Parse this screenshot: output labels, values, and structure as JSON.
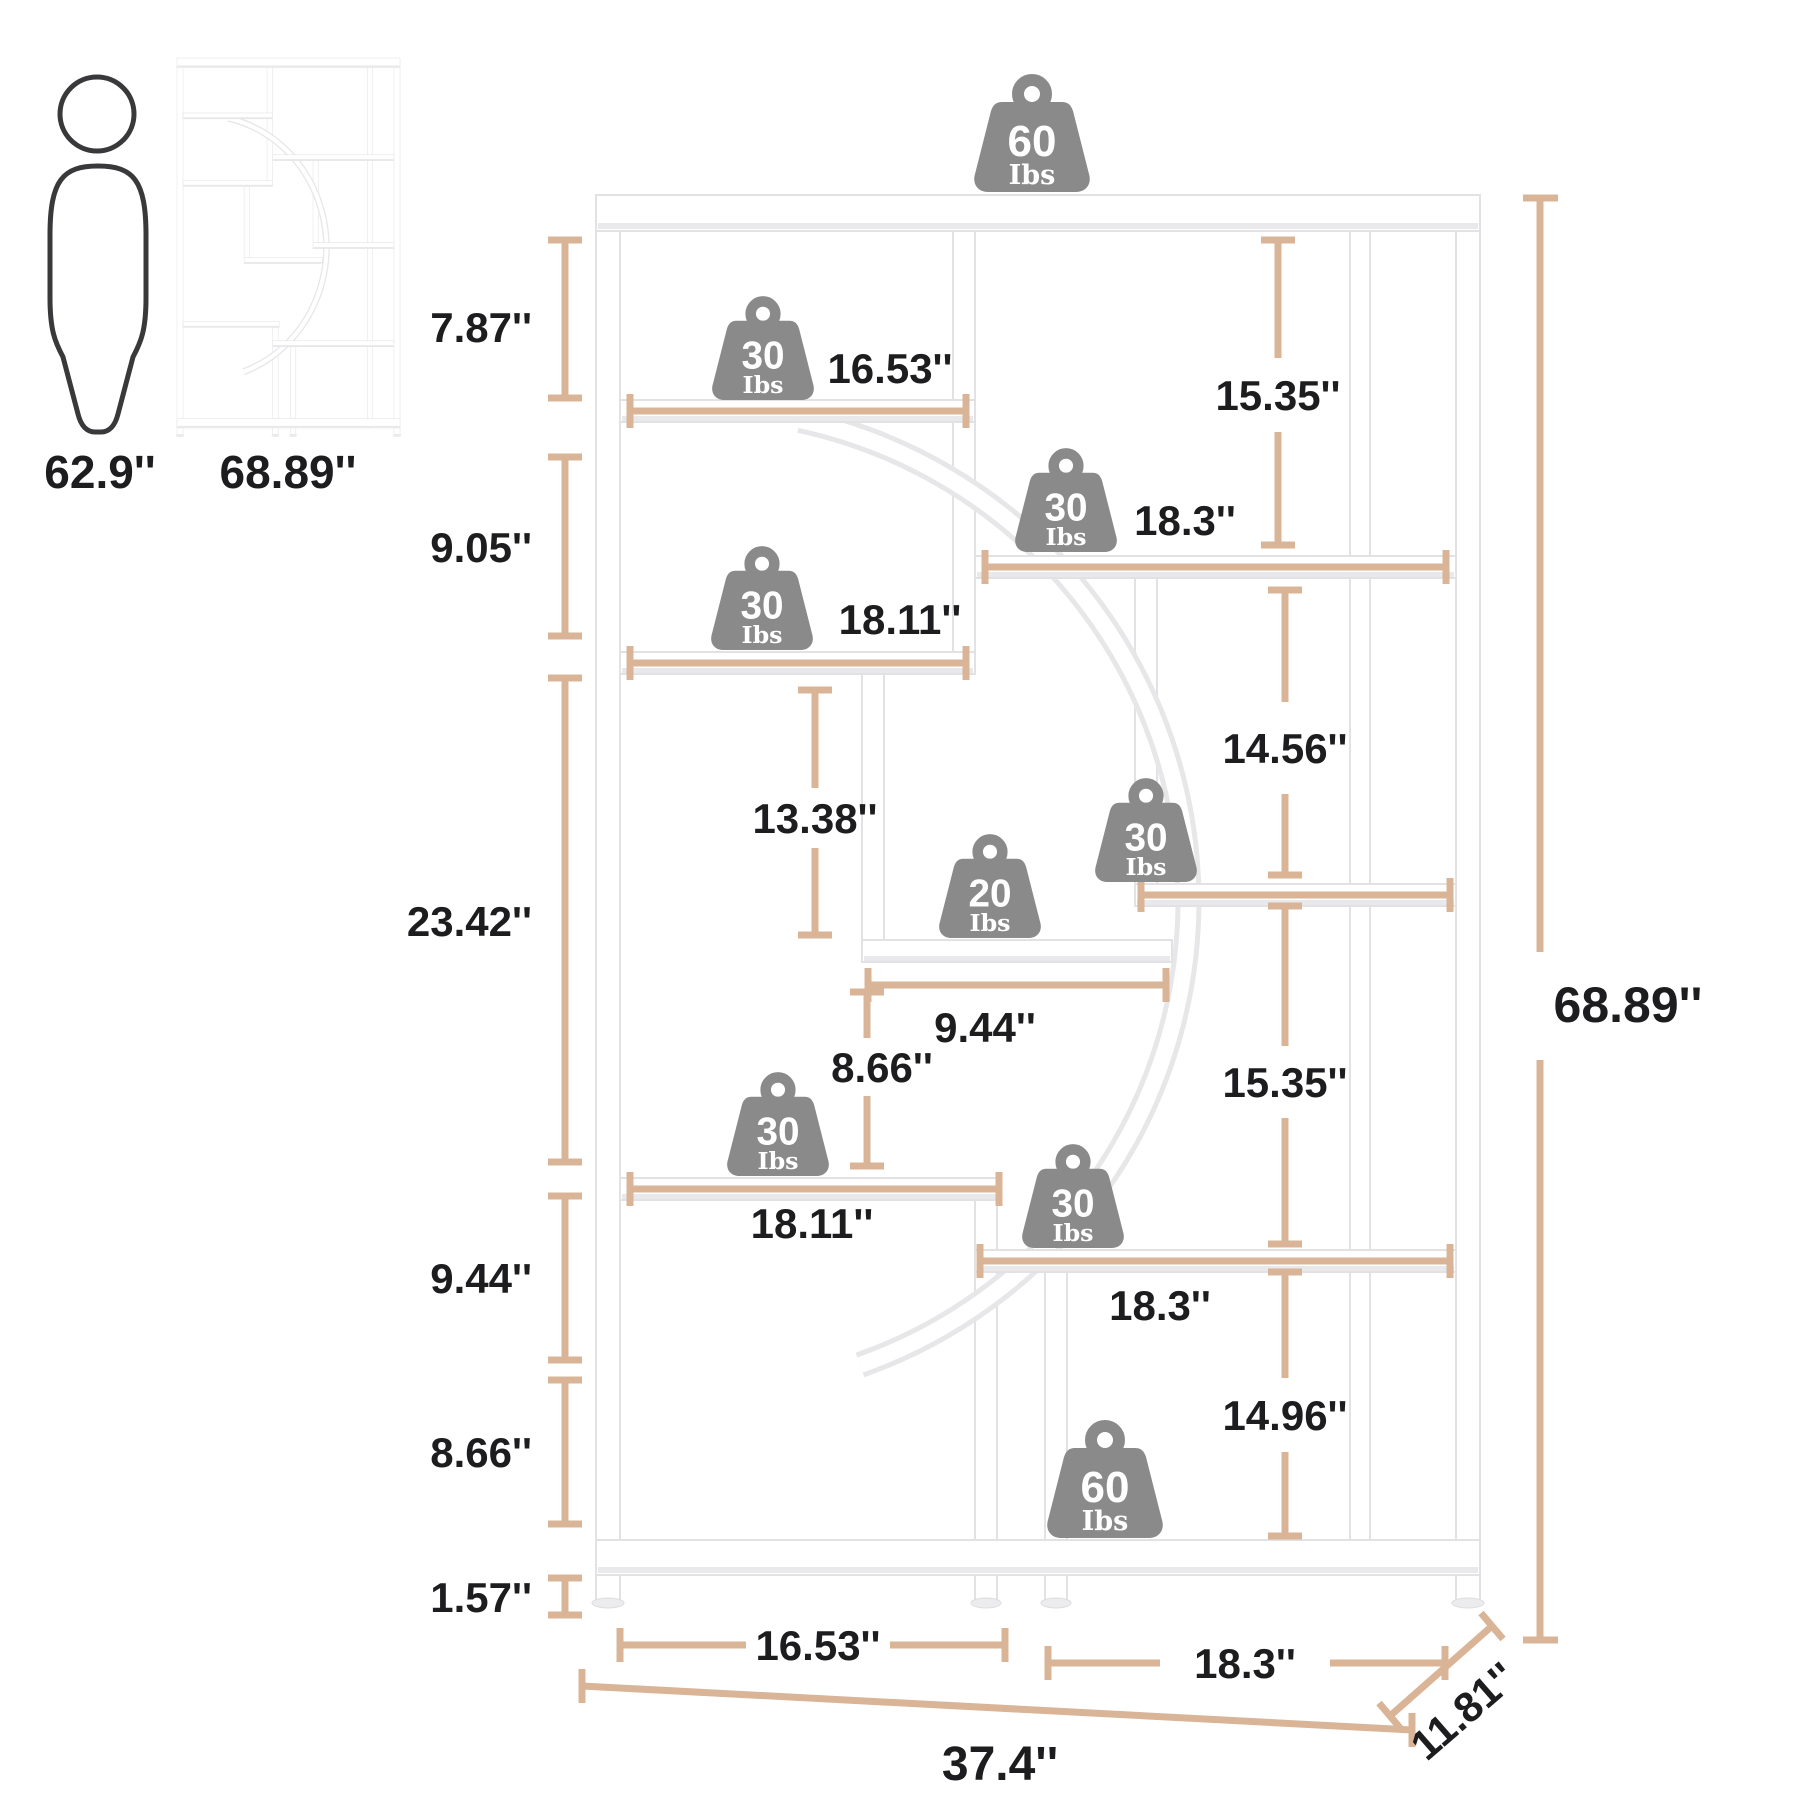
{
  "title": "Bookshelf dimension diagram",
  "colors": {
    "accent_tan": "#d9b497",
    "weight_gray": "#8a8a8a",
    "outline_dark": "#39393b",
    "text_dark": "#1d1d1f"
  },
  "reference": {
    "human_height": "62.9''",
    "shelf_height": "68.89''"
  },
  "weights": {
    "unit": "Ibs",
    "top": "60",
    "shelf1": "30",
    "shelf2": "30",
    "shelf3": "30",
    "small_shelf": "20",
    "shelf5": "30",
    "shelf6": "30",
    "shelf7": "30",
    "bottom": "60"
  },
  "dimensions": {
    "top_section": "7.87''",
    "second_section": "9.05''",
    "middle_section": "23.42''",
    "lower_section": "9.44''",
    "lower_second_section": "8.66''",
    "foot_height": "1.57''",
    "shelf1_width": "16.53''",
    "shelf2_width": "18.3''",
    "shelf3_width": "18.11''",
    "cell_height_left": "13.38''",
    "cell_height_right_upper": "14.56''",
    "right_top_section": "15.35''",
    "small_shelf_width": "9.44''",
    "cell_height_center": "8.66''",
    "right_mid_section": "15.35''",
    "shelf6_width": "18.11''",
    "shelf7_width": "18.3''",
    "right_lower_section": "14.96''",
    "bottom_left_width": "16.53''",
    "bottom_right_width": "18.3''",
    "overall_width": "37.4''",
    "depth": "11.81''",
    "overall_height": "68.89''"
  }
}
